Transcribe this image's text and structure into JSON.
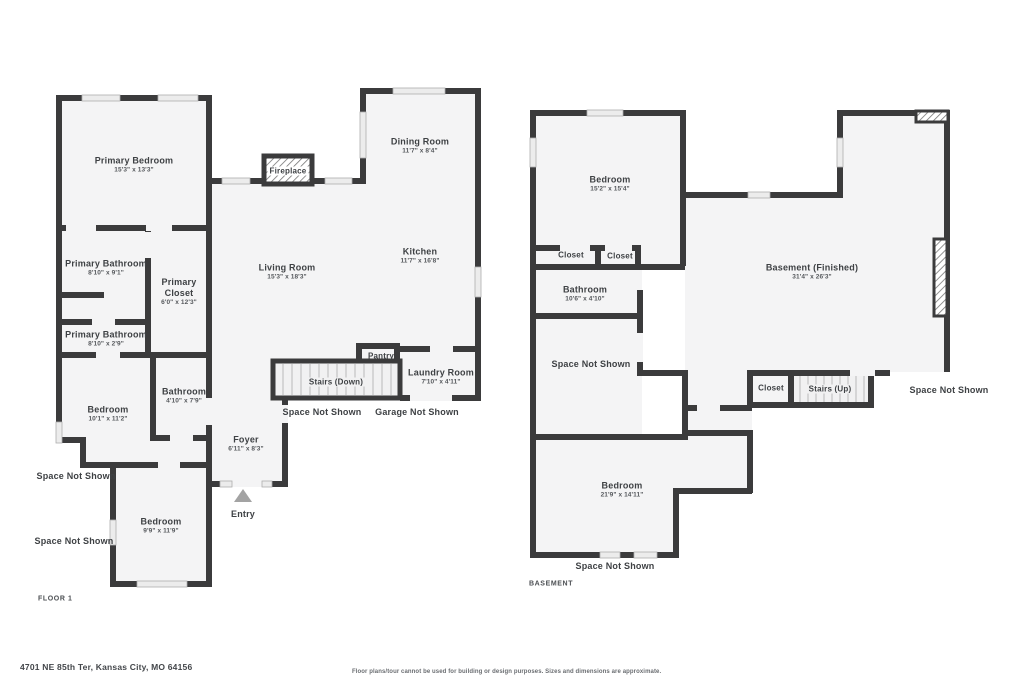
{
  "floor1": {
    "label": "FLOOR 1",
    "rooms": [
      {
        "name": "Primary Bedroom",
        "dims": "15'3\" x 13'3\""
      },
      {
        "name": "Dining Room",
        "dims": "11'7\" x 8'4\""
      },
      {
        "name": "Kitchen",
        "dims": "11'7\" x 16'8\""
      },
      {
        "name": "Living Room",
        "dims": "15'3\" x 18'3\""
      },
      {
        "name": "Primary Bathroom",
        "dims": "8'10\" x 9'1\""
      },
      {
        "name": "Primary Closet",
        "dims": "6'0\" x 12'3\""
      },
      {
        "name": "Primary Bathroom",
        "dims": "8'10\" x 2'9\""
      },
      {
        "name": "Bedroom",
        "dims": "10'1\" x 11'2\""
      },
      {
        "name": "Bathroom",
        "dims": "4'10\" x 7'9\""
      },
      {
        "name": "Laundry Room",
        "dims": "7'10\" x 4'11\""
      },
      {
        "name": "Foyer",
        "dims": "6'11\" x 8'3\""
      },
      {
        "name": "Bedroom",
        "dims": "9'9\" x 11'9\""
      }
    ],
    "features": {
      "fireplace": "Fireplace",
      "pantry": "Pantry",
      "stairs_down": "Stairs (Down)",
      "entry": "Entry"
    },
    "annotations": {
      "space_not_shown": "Space Not Shown",
      "garage_not_shown": "Garage Not Shown"
    }
  },
  "basement": {
    "label": "BASEMENT",
    "rooms": [
      {
        "name": "Bedroom",
        "dims": "15'2\" x 15'4\""
      },
      {
        "name": "Bathroom",
        "dims": "10'6\" x 4'10\""
      },
      {
        "name": "Basement (Finished)",
        "dims": "31'4\" x 26'3\""
      },
      {
        "name": "Bedroom",
        "dims": "21'9\" x 14'11\""
      }
    ],
    "features": {
      "closet": "Closet",
      "stairs_up": "Stairs (Up)"
    },
    "annotations": {
      "space_not_shown": "Space Not Shown"
    }
  },
  "footer": {
    "address": "4701 NE 85th Ter, Kansas City, MO 64156",
    "disclaimer": "Floor plans/tour cannot be used for building or design purposes. Sizes and dimensions are approximate."
  },
  "colors": {
    "wall": "#3b3b3c",
    "floor": "#f4f4f5",
    "window": "#ececec"
  }
}
